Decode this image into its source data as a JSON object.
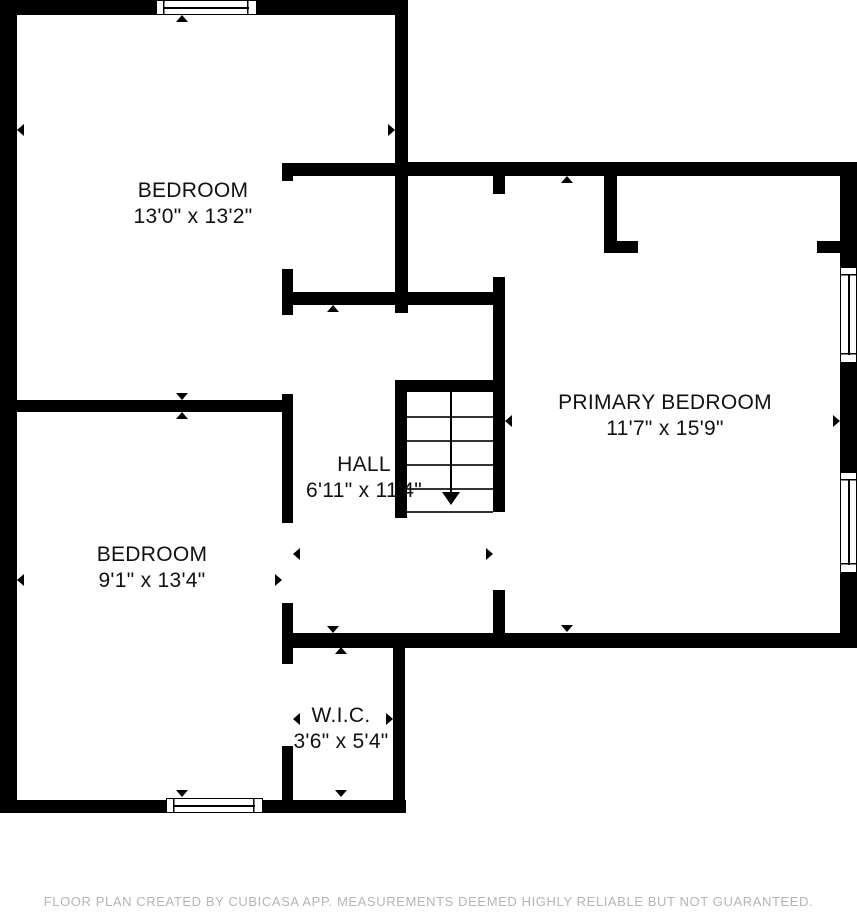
{
  "plan": {
    "source_note": "FLOOR PLAN CREATED BY CUBICASA APP. MEASUREMENTS DEEMED HIGHLY RELIABLE BUT NOT GUARANTEED.",
    "colors": {
      "wall": "#000000",
      "floor": "#ffffff",
      "label_text": "#111111",
      "footer_text": "#b5b5b5"
    },
    "rooms": [
      {
        "name": "BEDROOM",
        "dims": "13'0\" x 13'2\""
      },
      {
        "name": "BEDROOM",
        "dims": "9'1\" x 13'4\""
      },
      {
        "name": "HALL",
        "dims": "6'11\" x 11'4\""
      },
      {
        "name": "PRIMARY BEDROOM",
        "dims": "11'7\" x 15'9\""
      },
      {
        "name": "W.I.C.",
        "dims": "3'6\" x 5'4\""
      }
    ],
    "stairs": {
      "direction": "down",
      "step_lines": 5
    },
    "windows": {
      "count": 4
    }
  }
}
